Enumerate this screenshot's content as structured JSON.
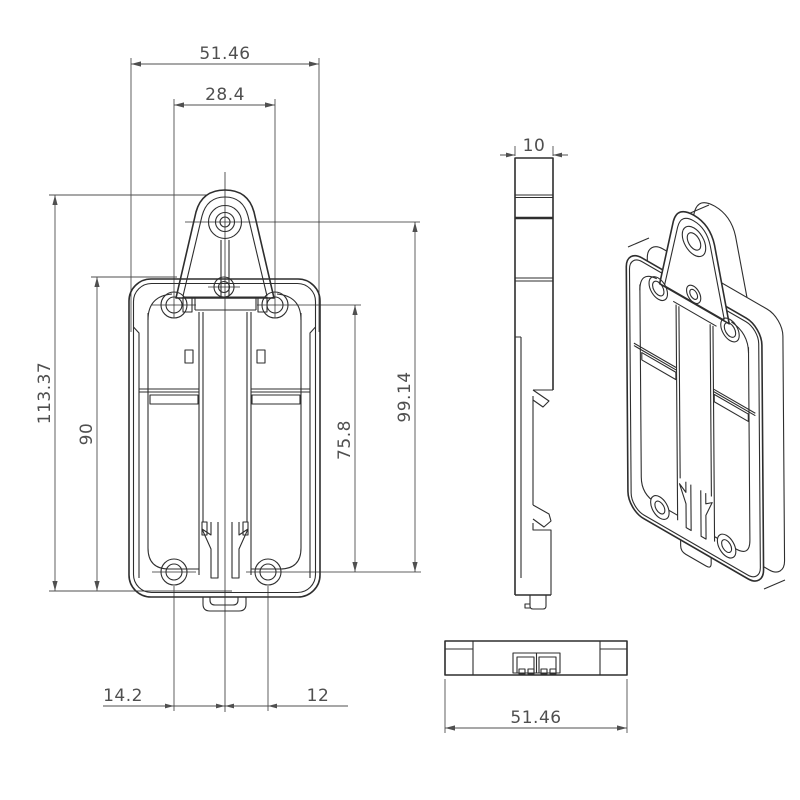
{
  "drawing": {
    "type": "technical-drawing",
    "views": [
      "front",
      "side",
      "isometric",
      "bottom"
    ],
    "colors": {
      "background": "#ffffff",
      "line": "#2e2e2e",
      "dimension": "#4f4f4f"
    },
    "dimensions": {
      "front": {
        "overall_width": "51.46",
        "top_hole_spacing": "28.4",
        "overall_height": "113.37",
        "body_height": "90",
        "tab_hole_to_bottom_holes": "99.14",
        "top_holes_to_bottom_holes": "75.8",
        "bottom_left_hole_offset": "14.2",
        "bottom_right_hole_offset": "12"
      },
      "side": {
        "thickness": "10"
      },
      "bottom": {
        "width": "51.46"
      }
    }
  }
}
